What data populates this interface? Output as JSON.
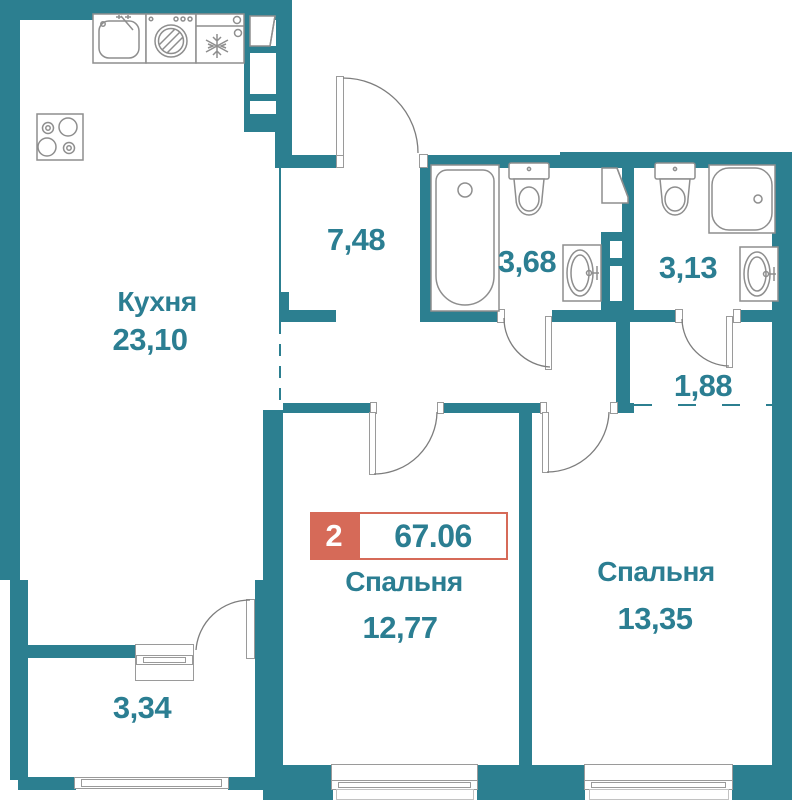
{
  "badge": {
    "room_count": "2",
    "total_area": "67.06"
  },
  "rooms": {
    "kitchen": {
      "name": "Кухня",
      "area": "23,10"
    },
    "entry_hall": {
      "area": "7,48"
    },
    "bathroom": {
      "area": "3,68"
    },
    "wc": {
      "area": "3,13"
    },
    "hallway": {
      "area": "1,88"
    },
    "bedroom1": {
      "name": "Спальня",
      "area": "12,77"
    },
    "bedroom2": {
      "name": "Спальня",
      "area": "13,35"
    },
    "balcony": {
      "area": "3,34"
    }
  },
  "colors": {
    "wall": "#2c7f90",
    "label": "#2b7e92",
    "accent": "#d66a58"
  },
  "icons": {
    "kitchen_sink": "kitchen-sink-icon",
    "washing_machine": "washer-icon",
    "fridge": "fridge-icon",
    "stove": "stove-icon",
    "bathtub": "bathtub-icon",
    "toilet": "toilet-icon",
    "wash_basin": "sink-icon",
    "shower_tray": "shower-tray-icon",
    "water_heater": "water-heater-icon",
    "vent_shaft": "vent-shaft",
    "door": "door-arc",
    "window": "window"
  }
}
